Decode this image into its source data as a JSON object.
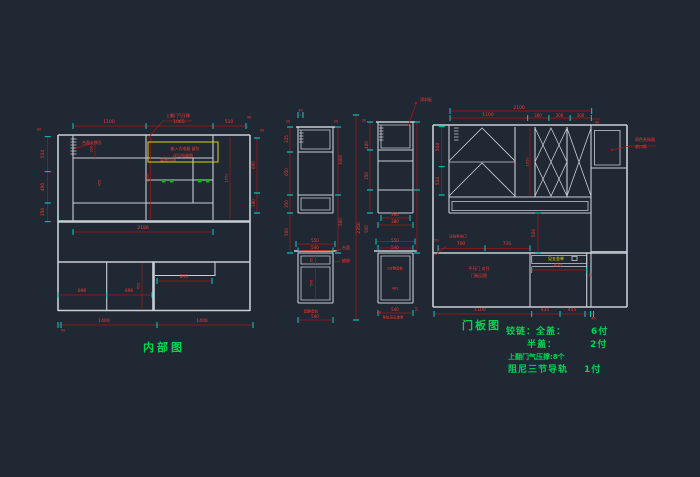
{
  "colors": {
    "background": "#202834",
    "structure_lines": "#c9ced4",
    "dimension_lines": "#b01510",
    "dimension_text": "#ff3a2e",
    "tick_marks": "#00e0e0",
    "annotation_green": "#00d455",
    "highlight_yellow": "#d6d60a"
  },
  "titles": {
    "left_view": "内部图",
    "right_view": "门板图"
  },
  "notes": {
    "hinge_full": "铰链：全盖：",
    "full_qty": "6付",
    "half_cover": "半盖：",
    "half_qty": "2付",
    "gas_strut": "上翻门气压撑:8个",
    "rail": "阻尼三节导轨",
    "rail_qty": "1付"
  },
  "labels": [
    {
      "t": "1100",
      "x": 109,
      "y": 123,
      "s": 4.5
    },
    {
      "t": "1065",
      "x": 179,
      "y": 123,
      "s": 4.5
    },
    {
      "t": "510",
      "x": 229,
      "y": 123,
      "s": 4.5
    },
    {
      "t": "40",
      "x": 249,
      "y": 117.5,
      "s": 3.5
    },
    {
      "t": "20",
      "x": 262,
      "y": 131,
      "s": 3.5
    },
    {
      "t": "514",
      "x": 44,
      "y": 154,
      "r": 1,
      "s": 4.5
    },
    {
      "t": "490",
      "x": 44,
      "y": 187,
      "r": 1,
      "s": 4.5
    },
    {
      "t": "350",
      "x": 44,
      "y": 212,
      "r": 1,
      "s": 4.5
    },
    {
      "t": "90",
      "x": 39,
      "y": 130,
      "s": 3.5
    },
    {
      "t": "600",
      "x": 253.5,
      "y": 165,
      "r": 1,
      "s": 4
    },
    {
      "t": "180",
      "x": 253.5,
      "y": 203,
      "r": 1,
      "s": 4
    },
    {
      "t": "2186",
      "x": 143,
      "y": 228.5,
      "s": 4.5
    },
    {
      "t": "696",
      "x": 82,
      "y": 291.5,
      "s": 4.5
    },
    {
      "t": "696",
      "x": 129,
      "y": 291.5,
      "s": 4.5
    },
    {
      "t": "840",
      "x": 184,
      "y": 277.5,
      "s": 4.5
    },
    {
      "t": "1400",
      "x": 104,
      "y": 321.5,
      "s": 4.5
    },
    {
      "t": "1400",
      "x": 202,
      "y": 321.5,
      "s": 4.5
    },
    {
      "t": "50",
      "x": 63,
      "y": 331,
      "s": 3.5
    },
    {
      "t": "上翻门气压撑",
      "x": 178,
      "y": 116,
      "s": 4
    },
    {
      "t": "嵌入式电器 留位",
      "x": 185,
      "y": 149,
      "s": 4
    },
    {
      "t": "详见电器图",
      "x": 183,
      "y": 156,
      "s": 4
    },
    {
      "t": "台面走线孔",
      "x": 92,
      "y": 143,
      "s": 4
    },
    {
      "t": "层板可调",
      "x": 168,
      "y": 160,
      "s": 4
    },
    {
      "t": "350",
      "x": 92,
      "y": 149,
      "r": 1,
      "s": 3.5
    },
    {
      "t": "450",
      "x": 100,
      "y": 183,
      "r": 1,
      "s": 3.5
    },
    {
      "t": "1650",
      "x": 147.5,
      "y": 178,
      "r": 1,
      "s": 3.5
    },
    {
      "t": "1650",
      "x": 227,
      "y": 178,
      "r": 1,
      "s": 3.5
    },
    {
      "t": "450",
      "x": 139,
      "y": 286,
      "r": 1,
      "s": 3.5
    },
    {
      "t": "40",
      "x": 300.5,
      "y": 111,
      "s": 3.5
    },
    {
      "t": "30",
      "x": 288,
      "y": 122,
      "s": 3.5
    },
    {
      "t": "20",
      "x": 336,
      "y": 122,
      "s": 3.5
    },
    {
      "t": "325",
      "x": 287,
      "y": 139,
      "r": 1,
      "s": 4
    },
    {
      "t": "650",
      "x": 287,
      "y": 172,
      "r": 1,
      "s": 4
    },
    {
      "t": "350",
      "x": 287,
      "y": 204,
      "r": 1,
      "s": 4
    },
    {
      "t": "500",
      "x": 287,
      "y": 232,
      "r": 1,
      "s": 4
    },
    {
      "t": "1000",
      "x": 341,
      "y": 160,
      "r": 1,
      "s": 4
    },
    {
      "t": "500",
      "x": 341,
      "y": 222,
      "r": 1,
      "s": 4
    },
    {
      "t": "2350",
      "x": 359.5,
      "y": 228,
      "r": 1,
      "s": 4.5
    },
    {
      "t": "550",
      "x": 315,
      "y": 241,
      "s": 4
    },
    {
      "t": "540",
      "x": 315,
      "y": 247.5,
      "s": 4
    },
    {
      "t": "95",
      "x": 312,
      "y": 260,
      "r": 1,
      "s": 3.5
    },
    {
      "t": "500",
      "x": 312,
      "y": 283,
      "r": 1,
      "s": 3.5
    },
    {
      "t": "540",
      "x": 315,
      "y": 316.5,
      "s": 4
    },
    {
      "t": "配静音轨",
      "x": 311,
      "y": 311.5,
      "s": 3.5
    },
    {
      "t": "台面",
      "x": 346,
      "y": 248,
      "s": 4
    },
    {
      "t": "抽屉",
      "x": 346,
      "y": 261,
      "s": 4
    },
    {
      "t": "480",
      "x": 367,
      "y": 145,
      "r": 1,
      "s": 4
    },
    {
      "t": "350",
      "x": 367,
      "y": 176,
      "r": 1,
      "s": 4
    },
    {
      "t": "500",
      "x": 367,
      "y": 229,
      "r": 1,
      "s": 4
    },
    {
      "t": "30",
      "x": 364,
      "y": 121,
      "s": 3.5
    },
    {
      "t": "顶封板",
      "x": 426,
      "y": 100,
      "s": 4
    },
    {
      "t": "360",
      "x": 395,
      "y": 214.5,
      "s": 4
    },
    {
      "t": "380",
      "x": 395,
      "y": 221.5,
      "s": 4
    },
    {
      "t": "550",
      "x": 395,
      "y": 241,
      "s": 4
    },
    {
      "t": "540",
      "x": 395,
      "y": 247.5,
      "s": 4
    },
    {
      "t": "1付静音轨",
      "x": 395,
      "y": 269,
      "s": 3.5
    },
    {
      "t": "481",
      "x": 395,
      "y": 289,
      "s": 3.5
    },
    {
      "t": "540",
      "x": 395,
      "y": 309.5,
      "s": 4
    },
    {
      "t": "40",
      "x": 379,
      "y": 313,
      "s": 3.5
    },
    {
      "t": "10",
      "x": 417,
      "y": 309,
      "r": 1,
      "s": 3.5
    },
    {
      "t": "导轨见五金单",
      "x": 393,
      "y": 317.5,
      "s": 3.5
    },
    {
      "t": "2100",
      "x": 519,
      "y": 108.5,
      "s": 4.5
    },
    {
      "t": "1100",
      "x": 488,
      "y": 115.5,
      "s": 4.5
    },
    {
      "t": "300",
      "x": 538,
      "y": 115.5,
      "s": 4
    },
    {
      "t": "300",
      "x": 559.5,
      "y": 115.5,
      "s": 4
    },
    {
      "t": "300",
      "x": 580.5,
      "y": 115.5,
      "s": 4
    },
    {
      "t": "40",
      "x": 597,
      "y": 122.5,
      "s": 3.5
    },
    {
      "t": "504",
      "x": 438.5,
      "y": 147,
      "r": 1,
      "s": 4.5
    },
    {
      "t": "514",
      "x": 438.5,
      "y": 181,
      "r": 1,
      "s": 4.5
    },
    {
      "t": "1050",
      "x": 527.5,
      "y": 162,
      "r": 1,
      "s": 3.5
    },
    {
      "t": "500",
      "x": 535,
      "y": 233,
      "r": 1,
      "s": 4.5
    },
    {
      "t": "700",
      "x": 461,
      "y": 244.5,
      "s": 4.5
    },
    {
      "t": "735",
      "x": 507,
      "y": 244.5,
      "s": 4.5
    },
    {
      "t": "50",
      "x": 436.5,
      "y": 240.5,
      "s": 3.5
    },
    {
      "t": "压线条收口",
      "x": 458,
      "y": 237,
      "s": 3.5
    },
    {
      "t": "870",
      "x": 558,
      "y": 266.5,
      "s": 4.5
    },
    {
      "t": "见五金单",
      "x": 556,
      "y": 259,
      "s": 4,
      "c": "yellow"
    },
    {
      "t": "1100",
      "x": 480,
      "y": 310.5,
      "s": 4.5
    },
    {
      "t": "435",
      "x": 545,
      "y": 310.5,
      "s": 4.5
    },
    {
      "t": "455",
      "x": 572,
      "y": 310.5,
      "s": 4.5
    },
    {
      "t": "45",
      "x": 593.5,
      "y": 319,
      "s": 3.5
    },
    {
      "t": "同色系饰面",
      "x": 645,
      "y": 140,
      "s": 4
    },
    {
      "t": "收口条",
      "x": 641,
      "y": 146.5,
      "s": 4
    },
    {
      "t": "平开门 对开",
      "x": 479,
      "y": 269,
      "s": 4
    },
    {
      "t": "门板见图",
      "x": 479,
      "y": 276,
      "s": 4
    },
    {
      "t": "40",
      "x": 590.5,
      "y": 275,
      "r": 1,
      "s": 3.5
    }
  ]
}
